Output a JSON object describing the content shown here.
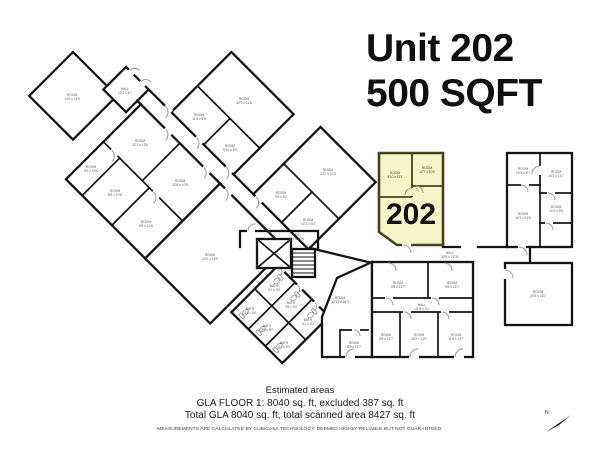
{
  "title": {
    "line1": "Unit 202",
    "line2": "500 SQFT"
  },
  "unit": {
    "number": "202"
  },
  "north": {
    "label": "N"
  },
  "footer": {
    "heading": "Estimated areas",
    "line1": "GLA FLOOR 1: 8040 sq. ft, excluded 387 sq. ft",
    "line2": "Total GLA 8040 sq. ft, total scanned area 8427 sq. ft",
    "disclaimer": "MEASUREMENTS ARE CALCULATED BY CUBICASA TECHNOLOGY. DEEMED HIGHLY RELIABLE BUT NOT GUARANTEED."
  },
  "colors": {
    "highlight_fill": "#F5F5C8",
    "highlight_wall": "#44441C",
    "wall": "#141414",
    "door_arc": "#9A9A9A"
  },
  "floorplan": {
    "rooms": [
      {
        "label": "ROOM",
        "dims": "14'9 x 14'9",
        "x": 72,
        "y": 96
      },
      {
        "label": "HALL",
        "dims": "12'0 x 6'7",
        "x": 125,
        "y": 90
      },
      {
        "label": "ROOM",
        "dims": "12'7 x 11'8",
        "x": 244,
        "y": 100
      },
      {
        "label": "ROOM",
        "dims": "11'6 x 8'9",
        "x": 199,
        "y": 116
      },
      {
        "label": "ROOM",
        "dims": "9'10 x 8'9",
        "x": 230,
        "y": 147
      },
      {
        "label": "ROOM",
        "dims": "13'2 x 10'4",
        "x": 328,
        "y": 171
      },
      {
        "label": "ROOM",
        "dims": "9'5 x 9'2",
        "x": 281,
        "y": 194
      },
      {
        "label": "ROOM",
        "dims": "10'1 x 9'2",
        "x": 308,
        "y": 221
      },
      {
        "label": "ROOM",
        "dims": "12'1 x 13'4",
        "x": 140,
        "y": 142
      },
      {
        "label": "ROOM",
        "dims": "12'6 x 10'9",
        "x": 180,
        "y": 182
      },
      {
        "label": "ROOM",
        "dims": "9'2 x 10'6",
        "x": 91,
        "y": 168
      },
      {
        "label": "ROOM",
        "dims": "8'5 x 10'6",
        "x": 115,
        "y": 192
      },
      {
        "label": "ROOM",
        "dims": "9'8 x 10'6",
        "x": 146,
        "y": 223
      },
      {
        "label": "ROOM",
        "dims": "20'0 x 14'9",
        "x": 210,
        "y": 256
      },
      {
        "label": "BATH",
        "dims": "4'1 x 5'2",
        "x": 274,
        "y": 287
      },
      {
        "label": "BATH",
        "dims": "3'9 x 5'2",
        "x": 291,
        "y": 304
      },
      {
        "label": "BATH",
        "dims": "4'1 x 5'2",
        "x": 308,
        "y": 321
      },
      {
        "label": "BATH",
        "dims": "4'1 x 5'0",
        "x": 250,
        "y": 310
      },
      {
        "label": "BATH",
        "dims": "3'9 x 5'0",
        "x": 267,
        "y": 327
      },
      {
        "label": "BATH",
        "dims": "4'1 x 5'0",
        "x": 284,
        "y": 344
      },
      {
        "label": "HALL",
        "dims": "16'1 x 20'9",
        "x": 296,
        "y": 236
      },
      {
        "label": "ROOM",
        "dims": "9'10 x 11'1",
        "x": 395,
        "y": 174,
        "accent": true
      },
      {
        "label": "ROOM",
        "dims": "10'7 x 10'0",
        "x": 427,
        "y": 169,
        "accent": true
      },
      {
        "label": "ROOM",
        "dims": "10'1 x 9'7",
        "x": 523,
        "y": 170
      },
      {
        "label": "ROOM",
        "dims": "10'2 x 11'7",
        "x": 556,
        "y": 173
      },
      {
        "label": "ROOM",
        "dims": "10'1 x 11'6",
        "x": 523,
        "y": 215
      },
      {
        "label": "ROOM",
        "dims": "10'2 x 9'5",
        "x": 556,
        "y": 208
      },
      {
        "label": "HALL",
        "dims": "30'9 x 23'10",
        "x": 450,
        "y": 254
      },
      {
        "label": "ROOM",
        "dims": "9'8 x 12'7",
        "x": 398,
        "y": 284
      },
      {
        "label": "ROOM",
        "dims": "9'6 x 12'7",
        "x": 452,
        "y": 284
      },
      {
        "label": "HALL",
        "dims": "21'8 x 3'1",
        "x": 422,
        "y": 306
      },
      {
        "label": "ROOM",
        "dims": "10'11 x 26'3",
        "x": 340,
        "y": 299
      },
      {
        "label": "ROOM",
        "dims": "8'9 x 11'7",
        "x": 354,
        "y": 344
      },
      {
        "label": "ROOM",
        "dims": "8'5 x 12'7",
        "x": 386,
        "y": 336
      },
      {
        "label": "ROOM",
        "dims": "10'2 x 12'7",
        "x": 419,
        "y": 336
      },
      {
        "label": "ROOM",
        "dims": "11'8 x 12'7",
        "x": 456,
        "y": 336
      },
      {
        "label": "ROOM",
        "dims": "20'5 x 16'7",
        "x": 538,
        "y": 293
      }
    ]
  }
}
